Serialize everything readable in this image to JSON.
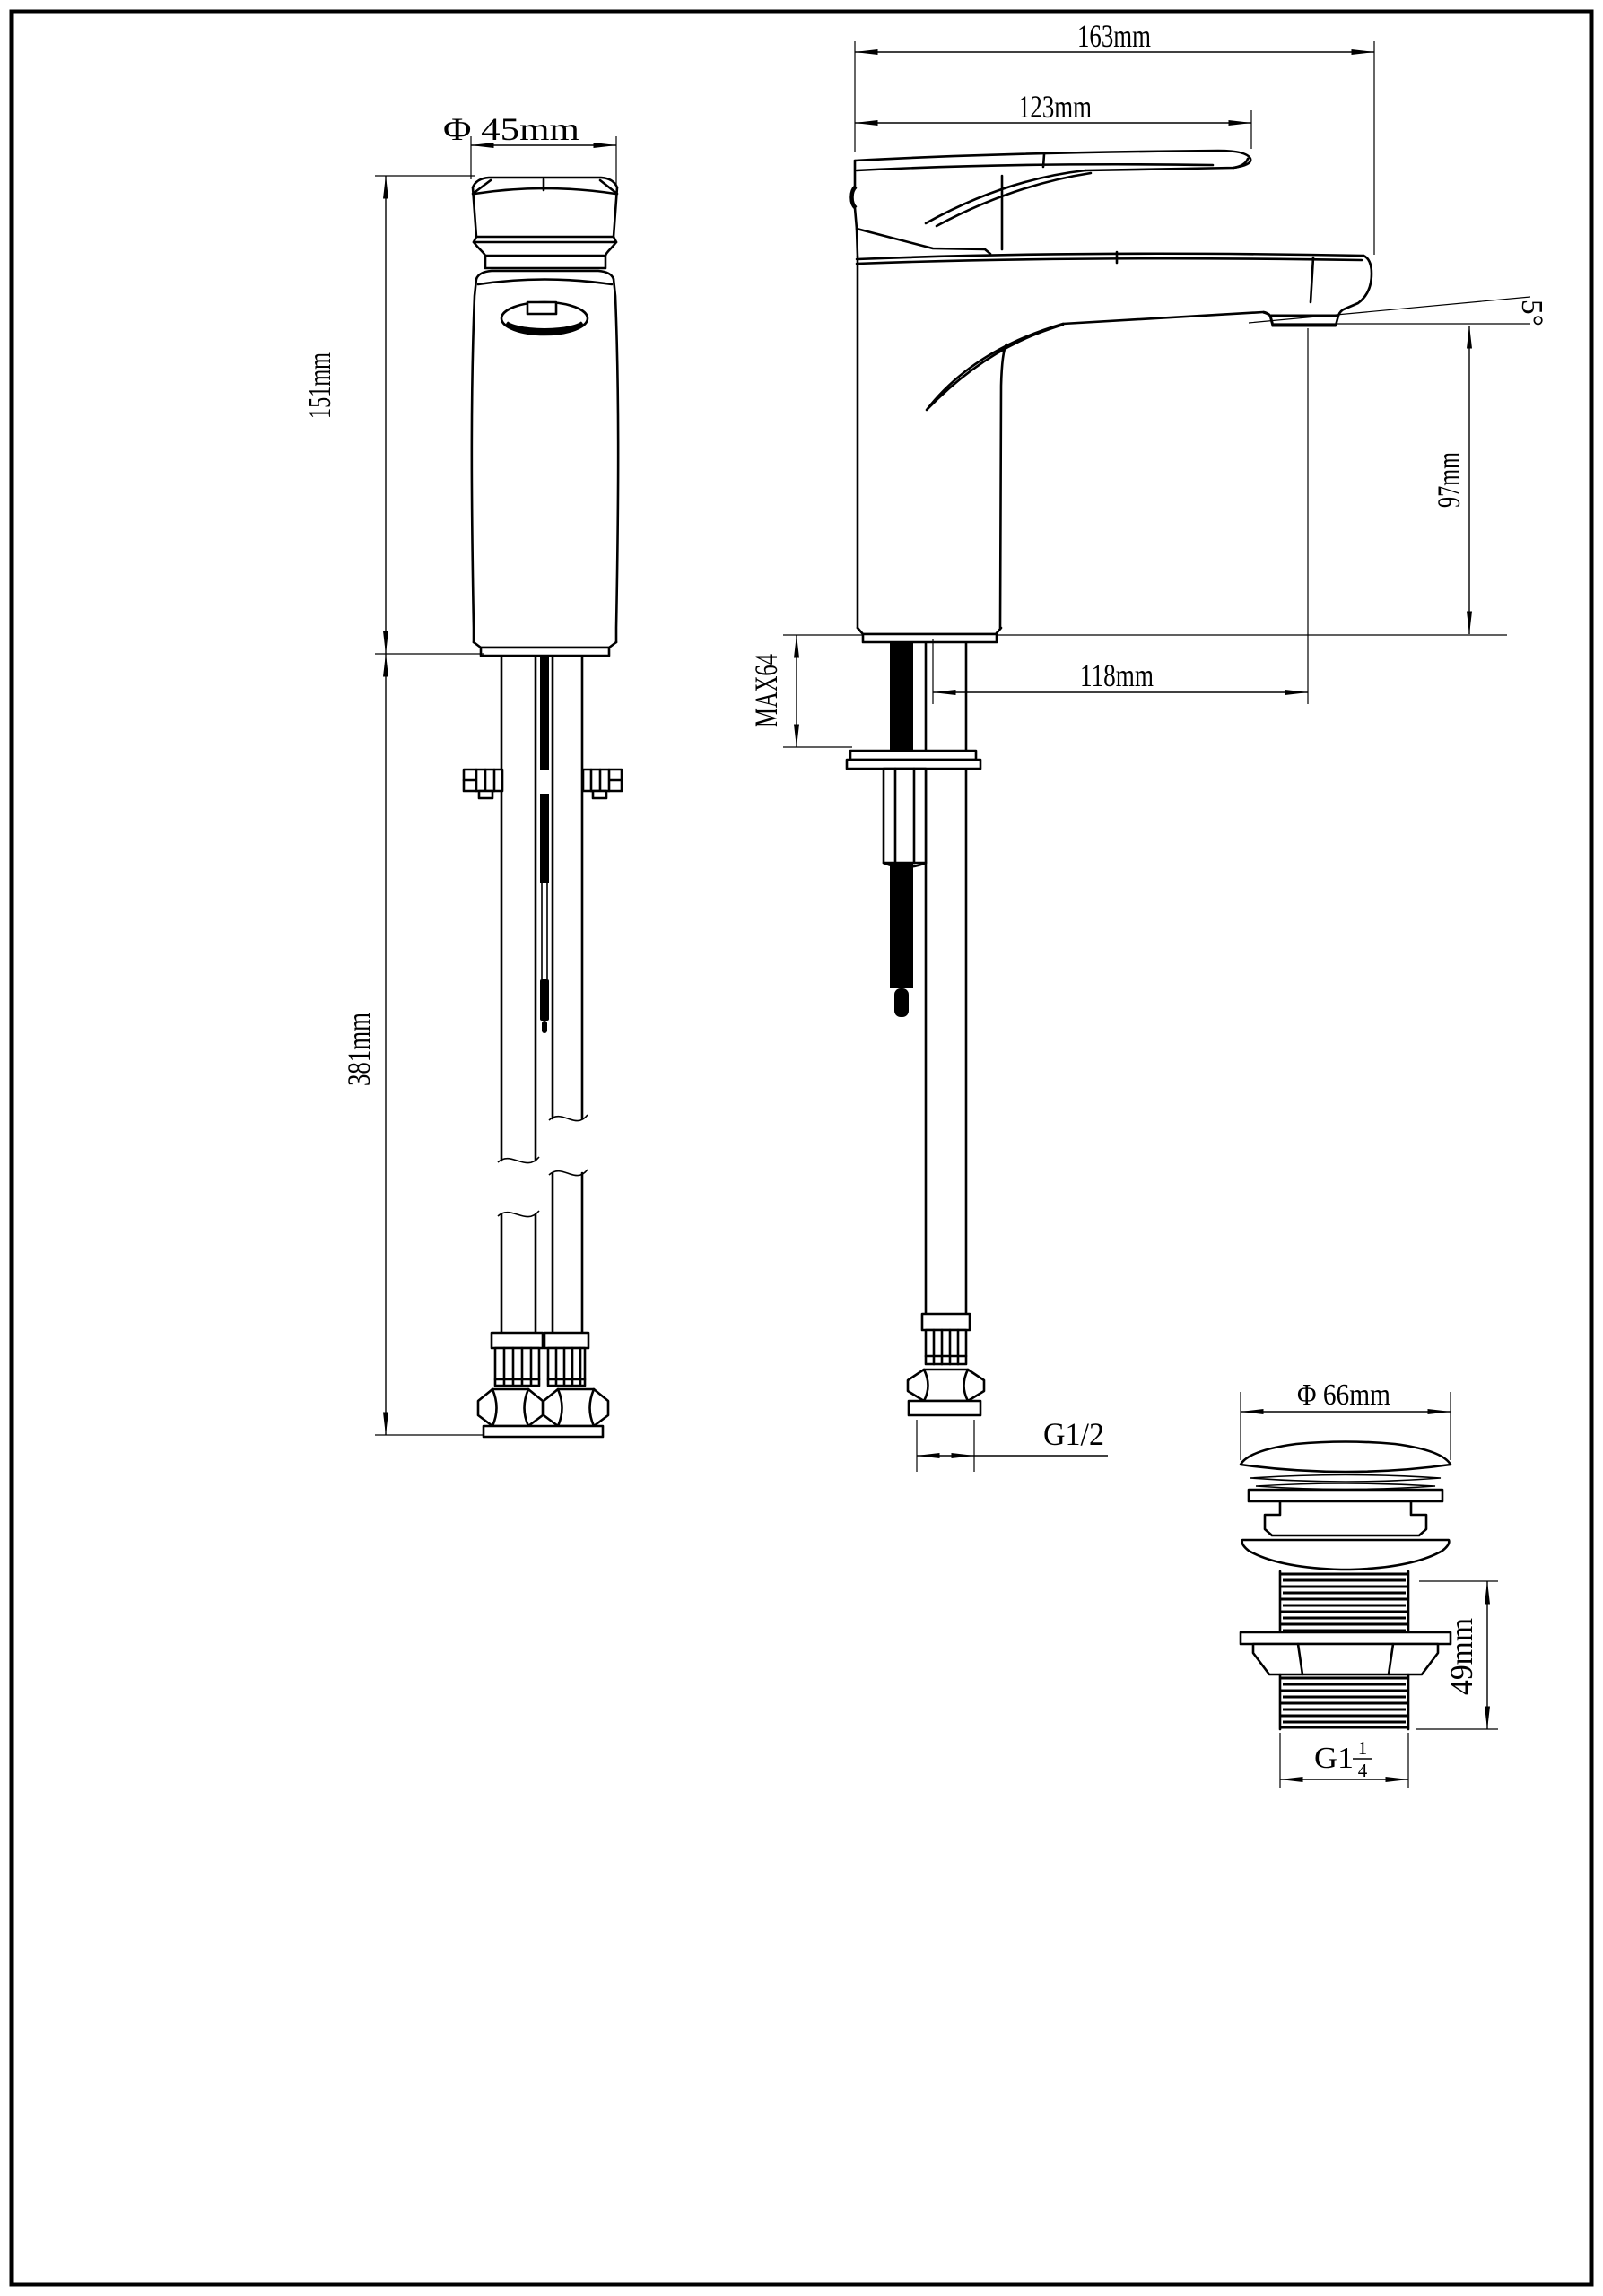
{
  "colors": {
    "line": "#000000",
    "background": "#ffffff"
  },
  "side_view": {
    "diameter": "Φ 45mm",
    "height": "151mm",
    "hose_length": "381mm"
  },
  "front_view": {
    "total_length": "163mm",
    "handle_length": "123mm",
    "spout_angle": "5°",
    "spout_height": "97mm",
    "spout_reach": "118mm",
    "max_mounting": "MAX64",
    "hose_thread": "G1/2"
  },
  "drain_view": {
    "cap_diameter": "Φ 66mm",
    "thread_length": "49mm",
    "thread_size_prefix": "G1",
    "thread_size_numerator": "1",
    "thread_size_denominator": "4"
  }
}
